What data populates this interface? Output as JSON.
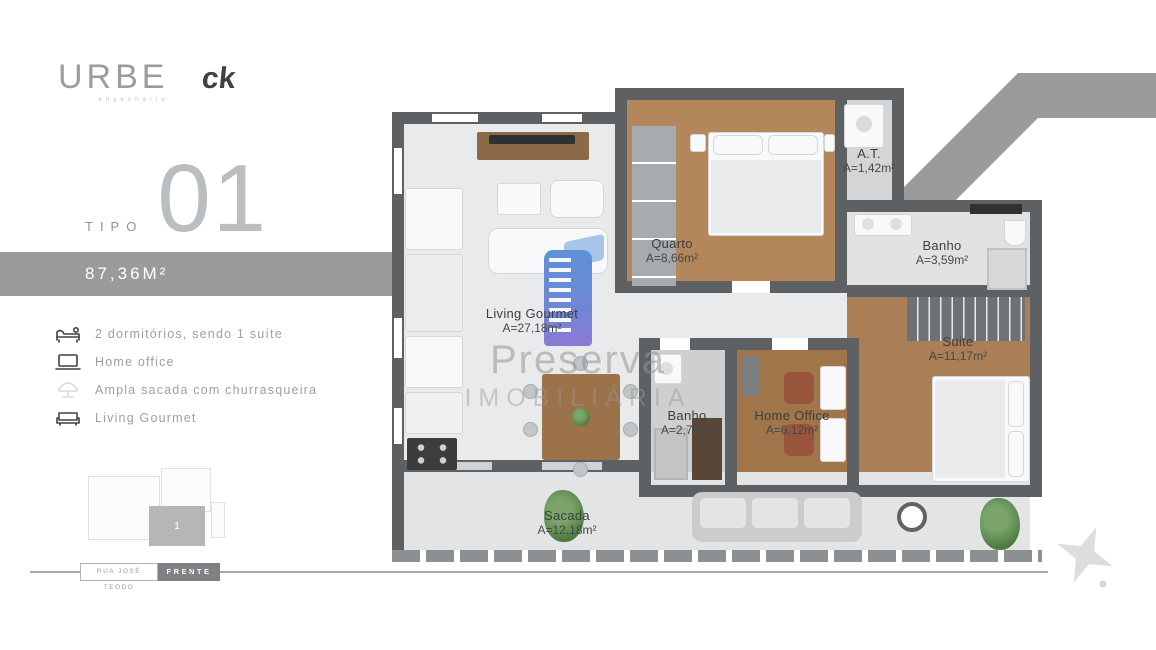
{
  "branding": {
    "logo_primary": "URBE",
    "logo_primary_sub": "engenharia",
    "logo_secondary": "ck"
  },
  "unit": {
    "type_label": "TIPO",
    "type_number": "01",
    "area_banner": "87,36M²"
  },
  "features": [
    {
      "icon": "bed-icon",
      "label": "2 dormitórios, sendo 1 suíte"
    },
    {
      "icon": "laptop-icon",
      "label": "Home office"
    },
    {
      "icon": "balcony-icon",
      "label": "Ampla sacada com churrasqueira"
    },
    {
      "icon": "sofa-icon",
      "label": "Living Gourmet"
    }
  ],
  "keyplan": {
    "unit_number": "1"
  },
  "location": {
    "street_label": "RUA JOSÉ TEODO",
    "front_label": "FRENTE"
  },
  "floorplan": {
    "watermark": {
      "line1": "Preserva",
      "line2": "IMOBILIÁRIA"
    },
    "rooms": [
      {
        "name": "Living Gourmet",
        "area": "A=27,18m²"
      },
      {
        "name": "Quarto",
        "area": "A=8,66m²"
      },
      {
        "name": "A.T.",
        "area": "A=1,42m²"
      },
      {
        "name": "Banho",
        "area": "A=3,59m²"
      },
      {
        "name": "Suite",
        "area": "A=11,17m²"
      },
      {
        "name": "Banho",
        "area": "A=2,70m²"
      },
      {
        "name": "Home Office",
        "area": "A=6,12m²"
      },
      {
        "name": "Sacada",
        "area": "A=12,18m²"
      }
    ]
  },
  "colors": {
    "banner_gray": "#9b9b9b",
    "ribbon_gray": "#9b9b9b",
    "wall_gray": "#5d6164",
    "wood_floor": "#b3865c",
    "tile_floor": "#e9eaeb",
    "watermark_blue": "#5e91d8",
    "front_badge": "#7f8184"
  }
}
